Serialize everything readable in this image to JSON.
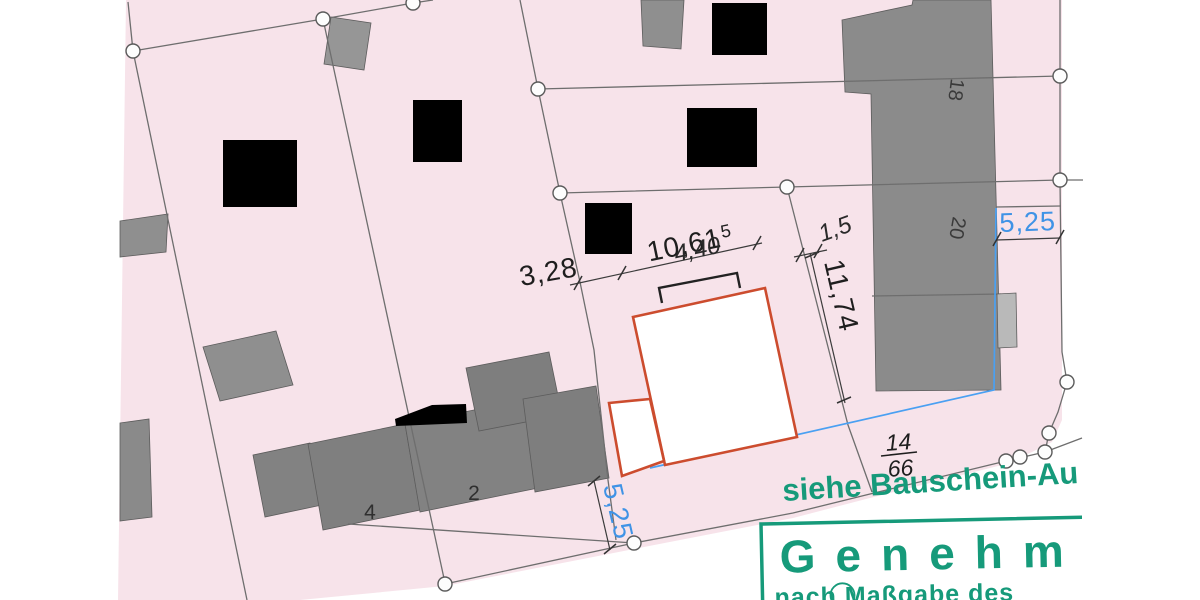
{
  "plan": {
    "dims": {
      "d_3_28": "3,28",
      "d_10_61": "10,61",
      "d_10_61_exp": "5",
      "d_4_40": "4,40",
      "d_1_5": "1,5",
      "d_11_74": "11,74",
      "d_5_25_right": "5,25",
      "d_5_25_bottom": "5,25"
    },
    "parcel": {
      "number_top": "14",
      "number_bottom": "66"
    },
    "buildings": {
      "house_18": "18",
      "house_20": "20",
      "house_2": "2",
      "house_4": "4"
    },
    "annotations": {
      "reference_note": "siehe Bauschein-Au"
    },
    "stamp": {
      "word": "Genehmi",
      "line2": "nach Maßgabe des"
    },
    "colors": {
      "parcel_pink": "#f7e3ea",
      "building_gray": "#8b8b8b",
      "proposed_outline_red": "#cc4c2e",
      "measure_blue": "#3f93e6",
      "stamp_green": "#169a7a"
    }
  }
}
